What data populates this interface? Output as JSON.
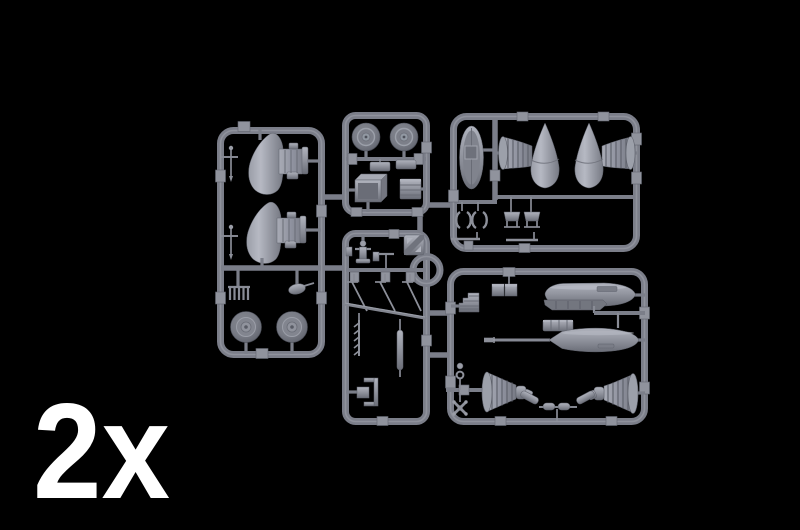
{
  "figure": {
    "subject": "Gray injection-molded model kit sprue (parts tree) photographed on a black background",
    "quantity_label": "2x"
  },
  "colors": {
    "background": "#000000",
    "label": "#ffffff",
    "runner": "#7b7e89",
    "runner_highlight": "#a3a6b0",
    "tab": "#90939d",
    "part_light": "#b0b3bd",
    "part_mid": "#8f929c",
    "part_dark": "#666973"
  },
  "frames": [
    {
      "id": "left",
      "parts": [
        "mast-pin",
        "mast-pin",
        "cowl-fin-half",
        "cowl-fin-half",
        "exhaust-stack-row",
        "small-fairing",
        "main-wheel",
        "main-wheel"
      ]
    },
    {
      "id": "top-middle",
      "parts": [
        "tail-wheel",
        "tail-wheel",
        "plate",
        "plate",
        "open-box",
        "ribbed-box"
      ]
    },
    {
      "id": "middle",
      "parts": [
        "placard",
        "control-figure",
        "t-handle",
        "antenna-rod",
        "antenna-rod",
        "antenna-rod",
        "diagonal-strip",
        "boarding-ladder",
        "long-rod",
        "bracket",
        "small-box",
        "intake-ring"
      ]
    },
    {
      "id": "top-right",
      "parts": [
        "access-panel",
        "spinner-with-manifold",
        "spinner-with-manifold",
        "clamp",
        "clamp",
        "seat-frame",
        "seat-frame",
        "thin-rod",
        "thin-rod"
      ]
    },
    {
      "id": "bottom-right",
      "parts": [
        "louver-steps",
        "twin-box",
        "drop-tank-half",
        "tank-pylon",
        "drop-tank-half",
        "gun-barrel",
        "equipment-box",
        "bellows-cowl",
        "bellows-cowl",
        "link-rod",
        "link-rod",
        "cylinder",
        "cylinder",
        "ring-pin",
        "x-brace"
      ]
    }
  ]
}
